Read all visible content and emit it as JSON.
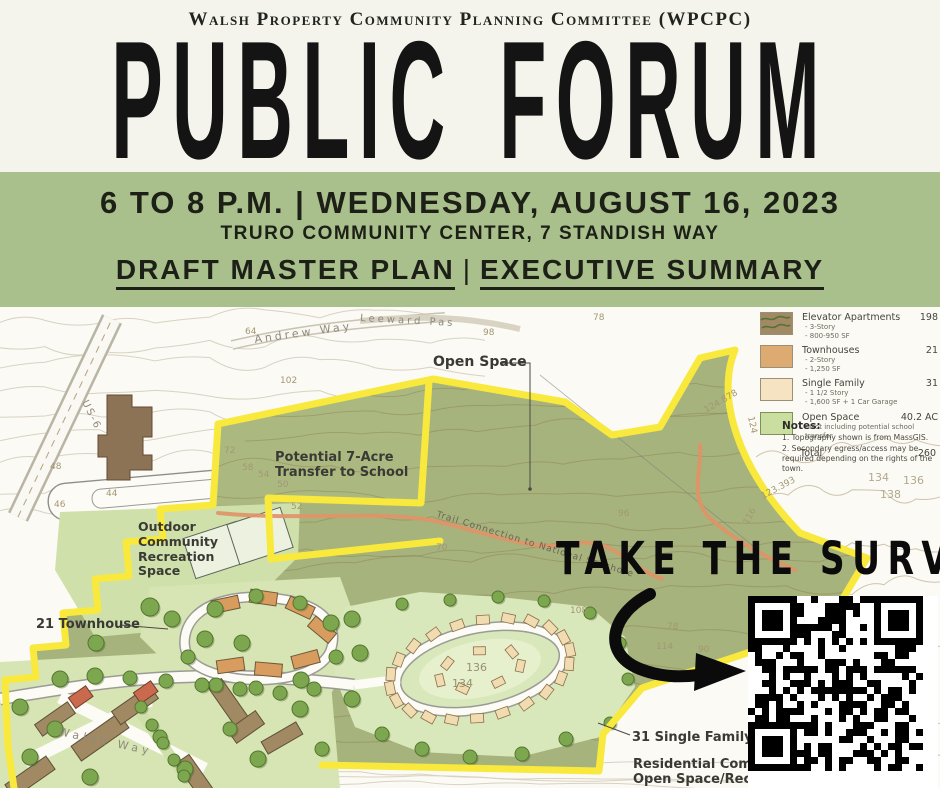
{
  "header": {
    "committee": "Walsh Property Community Planning Committee (WPCPC)",
    "title": "PUBLIC FORUM"
  },
  "banner": {
    "line1": "6 TO 8 P.M. | WEDNESDAY, AUGUST 16, 2023",
    "line2": "TRURO COMMUNITY CENTER, 7 STANDISH WAY",
    "line3a": "DRAFT MASTER PLAN",
    "divider": "|",
    "line3b": "EXECUTIVE SUMMARY"
  },
  "map": {
    "streets": {
      "andrew_way": "Andrew Way",
      "leeward": "Leeward Pas",
      "us6": "US-6",
      "walsh_way": "Walsh Way"
    },
    "labels": {
      "open_space": "Open Space",
      "school_line1": "Potential 7-Acre",
      "school_line2": "Transfer to School",
      "recreation_line1": "Outdoor",
      "recreation_line2": "Community",
      "recreation_line3": "Recreation",
      "recreation_line4": "Space",
      "townhouse": "21 Townhouse",
      "trail": "Trail Connection to National Seashore",
      "single_family": "31 Single Family",
      "residential_line1": "Residential Communi",
      "residential_line2": "Open Space/Recreati"
    },
    "contours": [
      "64",
      "98",
      "102",
      "78",
      "72",
      "58",
      "54",
      "50",
      "52",
      "96",
      "70",
      "78",
      "114",
      "90",
      "108",
      "134",
      "136",
      "134",
      "136",
      "138",
      "123.393",
      "124.878",
      "124",
      "116",
      "44",
      "46",
      "48"
    ]
  },
  "legend": {
    "items": [
      {
        "label": "Elevator Apartments",
        "value": "198",
        "details": [
          "- 3-Story",
          "- 800-950 SF"
        ],
        "swatch": "#a18a63"
      },
      {
        "label": "Townhouses",
        "value": "21",
        "details": [
          "- 2-Story",
          "- 1,250 SF"
        ],
        "swatch": "#ddab72"
      },
      {
        "label": "Single Family",
        "value": "31",
        "details": [
          "- 1 1/2 Story",
          "- 1,600 SF + 1 Car Garage"
        ],
        "swatch": "#f5e3c1"
      },
      {
        "label": "Open Space",
        "value": "40.2 AC",
        "details": [
          "- Not including potential school transfer"
        ],
        "swatch": "#cade9f"
      }
    ],
    "total_label": "Total",
    "total_value": "260"
  },
  "notes": {
    "heading": "Notes:",
    "items": [
      "1. Topography shown is from MassGIS.",
      "2. Secondary egress/access may be required depending on the rights of the town."
    ]
  },
  "survey": {
    "cta": "TAKE THE SURVEY"
  },
  "colors": {
    "banner_green": "#a9bf8c",
    "cream": "#f5f4ec",
    "open_space_green": "#a6b37c",
    "pod_green": "#d6e5b3",
    "boundary_yellow": "#f8e93c",
    "townhouse_orange": "#d89c5e",
    "apartment_brown": "#a18a63",
    "single_family_tan": "#f1dbb0",
    "trail_orange": "#df9468",
    "qr_black": "#000000"
  }
}
